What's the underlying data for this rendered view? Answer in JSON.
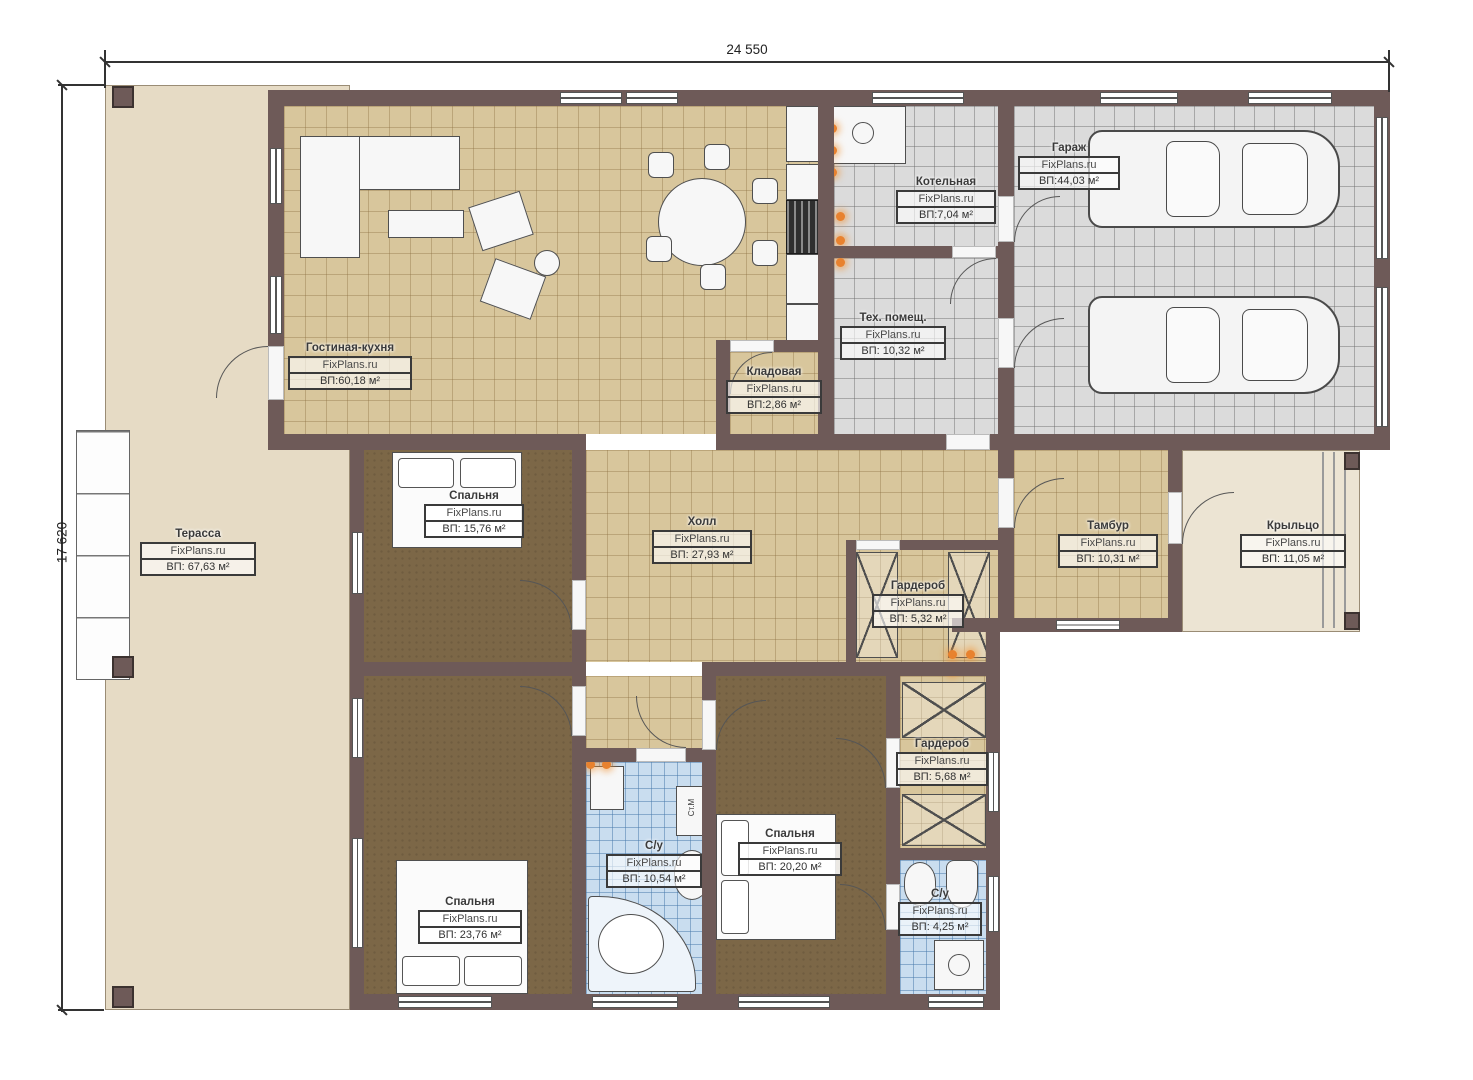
{
  "watermark": "FixPlans.ru",
  "dimensions": {
    "width_label": "24 550",
    "height_label": "17 620"
  },
  "rooms": [
    {
      "name": "Терасса",
      "area": "ВП: 67,63 м²"
    },
    {
      "name": "Гостиная-кухня",
      "area": "ВП:60,18 м²"
    },
    {
      "name": "Котельная",
      "area": "ВП:7,04 м²"
    },
    {
      "name": "Гараж",
      "area": "ВП:44,03 м²"
    },
    {
      "name": "Тех. помещ.",
      "area": "ВП: 10,32 м²"
    },
    {
      "name": "Кладовая",
      "area": "ВП:2,86 м²"
    },
    {
      "name": "Спальня",
      "area": "ВП: 15,76 м²"
    },
    {
      "name": "Холл",
      "area": "ВП: 27,93 м²"
    },
    {
      "name": "Тамбур",
      "area": "ВП: 10,31 м²"
    },
    {
      "name": "Крыльцо",
      "area": "ВП: 11,05 м²"
    },
    {
      "name": "Гардероб",
      "area": "ВП: 5,32 м²"
    },
    {
      "name": "Гардероб",
      "area": "ВП: 5,68 м²"
    },
    {
      "name": "Спальня",
      "area": "ВП: 23,76 м²"
    },
    {
      "name": "С/у",
      "area": "ВП: 10,54 м²"
    },
    {
      "name": "Спальня",
      "area": "ВП: 20,20 м²"
    },
    {
      "name": "С/у",
      "area": "ВП: 4,25 м²"
    }
  ],
  "equipment": {
    "washing_machine": "Ст.М"
  },
  "colors": {
    "wall": "#6e5a58",
    "living_floor": "#d8c69c",
    "garage_floor": "#dbdbdb",
    "bedroom_floor": "#7c6747",
    "bath_floor": "#c9ddef",
    "terrace": "#e6dbc5",
    "porch": "#ece4d3",
    "accent_orange": "#e8822f"
  }
}
